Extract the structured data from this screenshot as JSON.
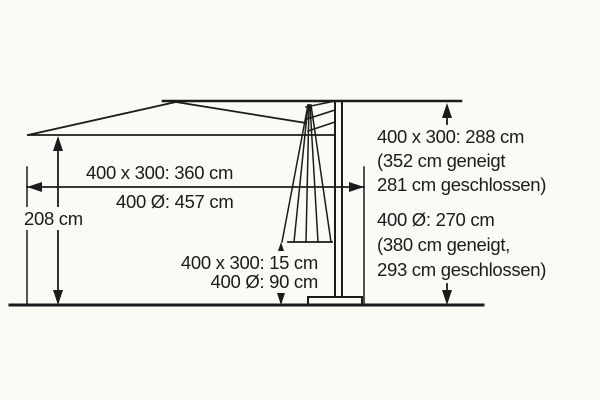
{
  "figure": {
    "title": "cantilever-parasol-dimension-diagram",
    "background": "#fbfaf5",
    "line_color": "#1b1b1b",
    "labels": {
      "span_width_rect": "400 x 300: 360 cm",
      "span_width_round": "400 Ø: 457 cm",
      "clearance_height": "208 cm",
      "pole_offset_rect": "400 x 300: 15 cm",
      "pole_offset_round": "400 Ø: 90 cm",
      "total_height_rect_line1": "400 x 300: 288 cm",
      "total_height_rect_line2": "(352 cm geneigt",
      "total_height_rect_line3": "281 cm geschlossen)",
      "total_height_round_line1": "400 Ø: 270 cm",
      "total_height_round_line2": "(380 cm geneigt,",
      "total_height_round_line3": "293 cm geschlossen)"
    }
  }
}
